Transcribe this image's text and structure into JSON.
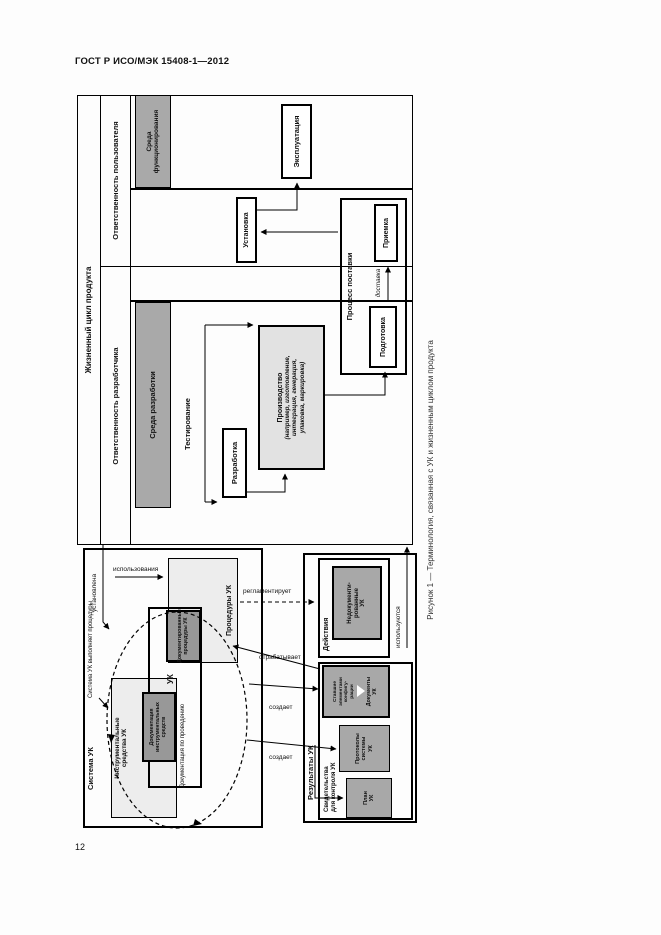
{
  "page": {
    "header": "ГОСТ Р ИСО/МЭК 15408-1—2012",
    "page_number": "12"
  },
  "caption": "Рисунок 1 — Терминология, связанная с УК и жизненным циклом продукта",
  "lifecycle": {
    "title": "Жизненный цикл продукта",
    "developer_responsibility": "Ответственность разработчика",
    "user_responsibility": "Ответственность пользователя",
    "dev_env": "Среда разработки",
    "op_env": "Среда\nфункционирования",
    "testing": "Тестирование",
    "development": "Разработка",
    "production": "Производство",
    "production_note": "(например, изготовление,\nинтеграция, генерация,\nупаковка, маркировка)",
    "delivery_process": "Процесс поставки",
    "preparation": "Подготовка",
    "delivery": "доставка",
    "acceptance": "Приемка",
    "installation": "Установка",
    "operation": "Эксплуатация"
  },
  "cm_system": {
    "title": "Система УК",
    "callout": "Система УК\nвыполняет\nпроцедуры",
    "procedures_box": "Процедуры УК",
    "documented_procedures": "Документированные\nпроцедуры УК",
    "uk_label": "УК",
    "tools_box": "Инструментальные\nсредства УК",
    "tools_documentation": "Документация\nинструментальных\nсредств",
    "conduct_documentation": "Документация\nпо проведению"
  },
  "cm_output": {
    "title": "Результаты УК",
    "actions": "Действия",
    "undocumented": "Недокументи-\nрованные\nУК",
    "evidence_group": "Свидетельства\nдля контроля УК",
    "config_items": "Ставшие\nэлементами\nконфигу-\nрации",
    "cm_documents": "Документы\nУК",
    "records": "Протоколы\nсистемы\nУК",
    "plan": "План\nУК"
  },
  "arrows": {
    "installed": "установлена",
    "usage": "использования",
    "governs": "регламентирует",
    "processes": "отрабатывает",
    "creates1": "создает",
    "creates2": "создает",
    "used": "используются"
  }
}
